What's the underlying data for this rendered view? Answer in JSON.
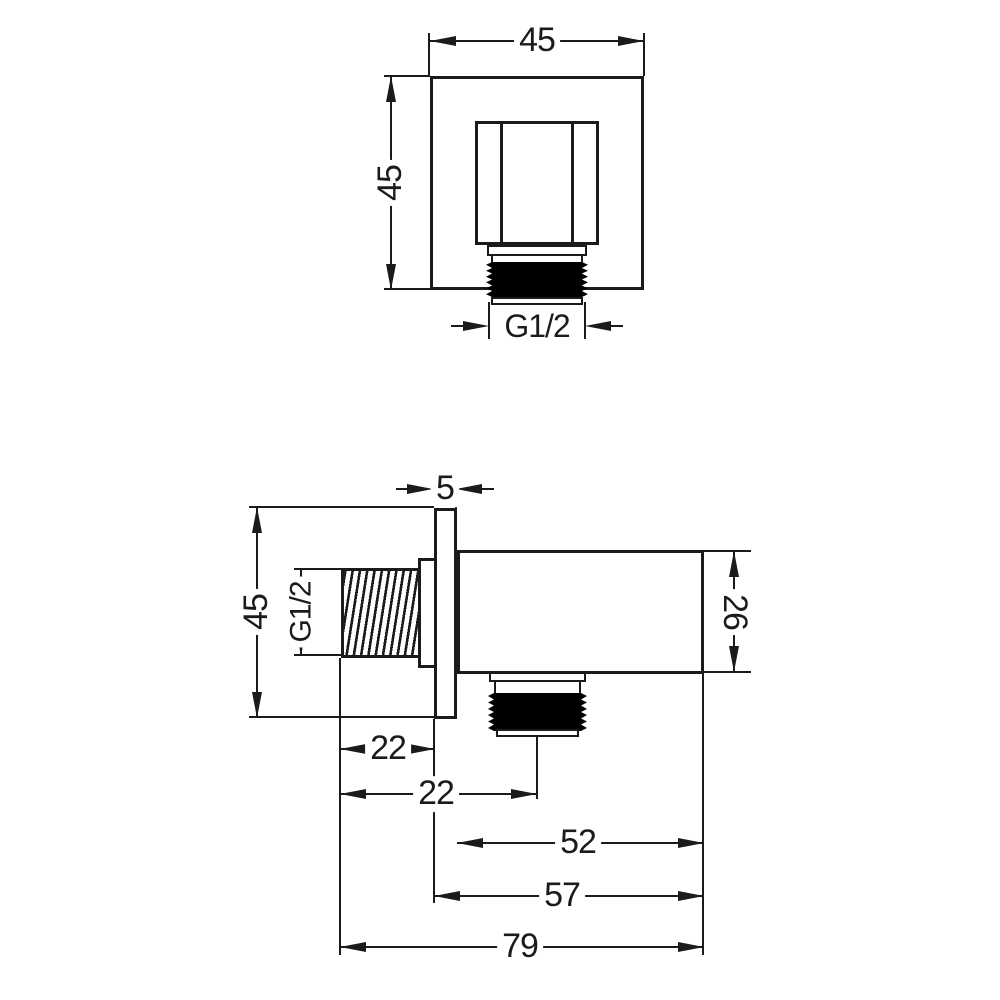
{
  "colors": {
    "line": "#1b1b1b",
    "thread_fill": "#000000",
    "background": "#ffffff"
  },
  "views": {
    "front": {
      "width": "45",
      "height": "45",
      "thread": "G1/2"
    },
    "side": {
      "plate_thickness": "5",
      "height": "45",
      "thread": "G1/2",
      "body_height": "26",
      "thread_length": "22",
      "outlet_center": "22",
      "body_length": "52",
      "body_with_plate": "57",
      "total_length": "79"
    }
  }
}
